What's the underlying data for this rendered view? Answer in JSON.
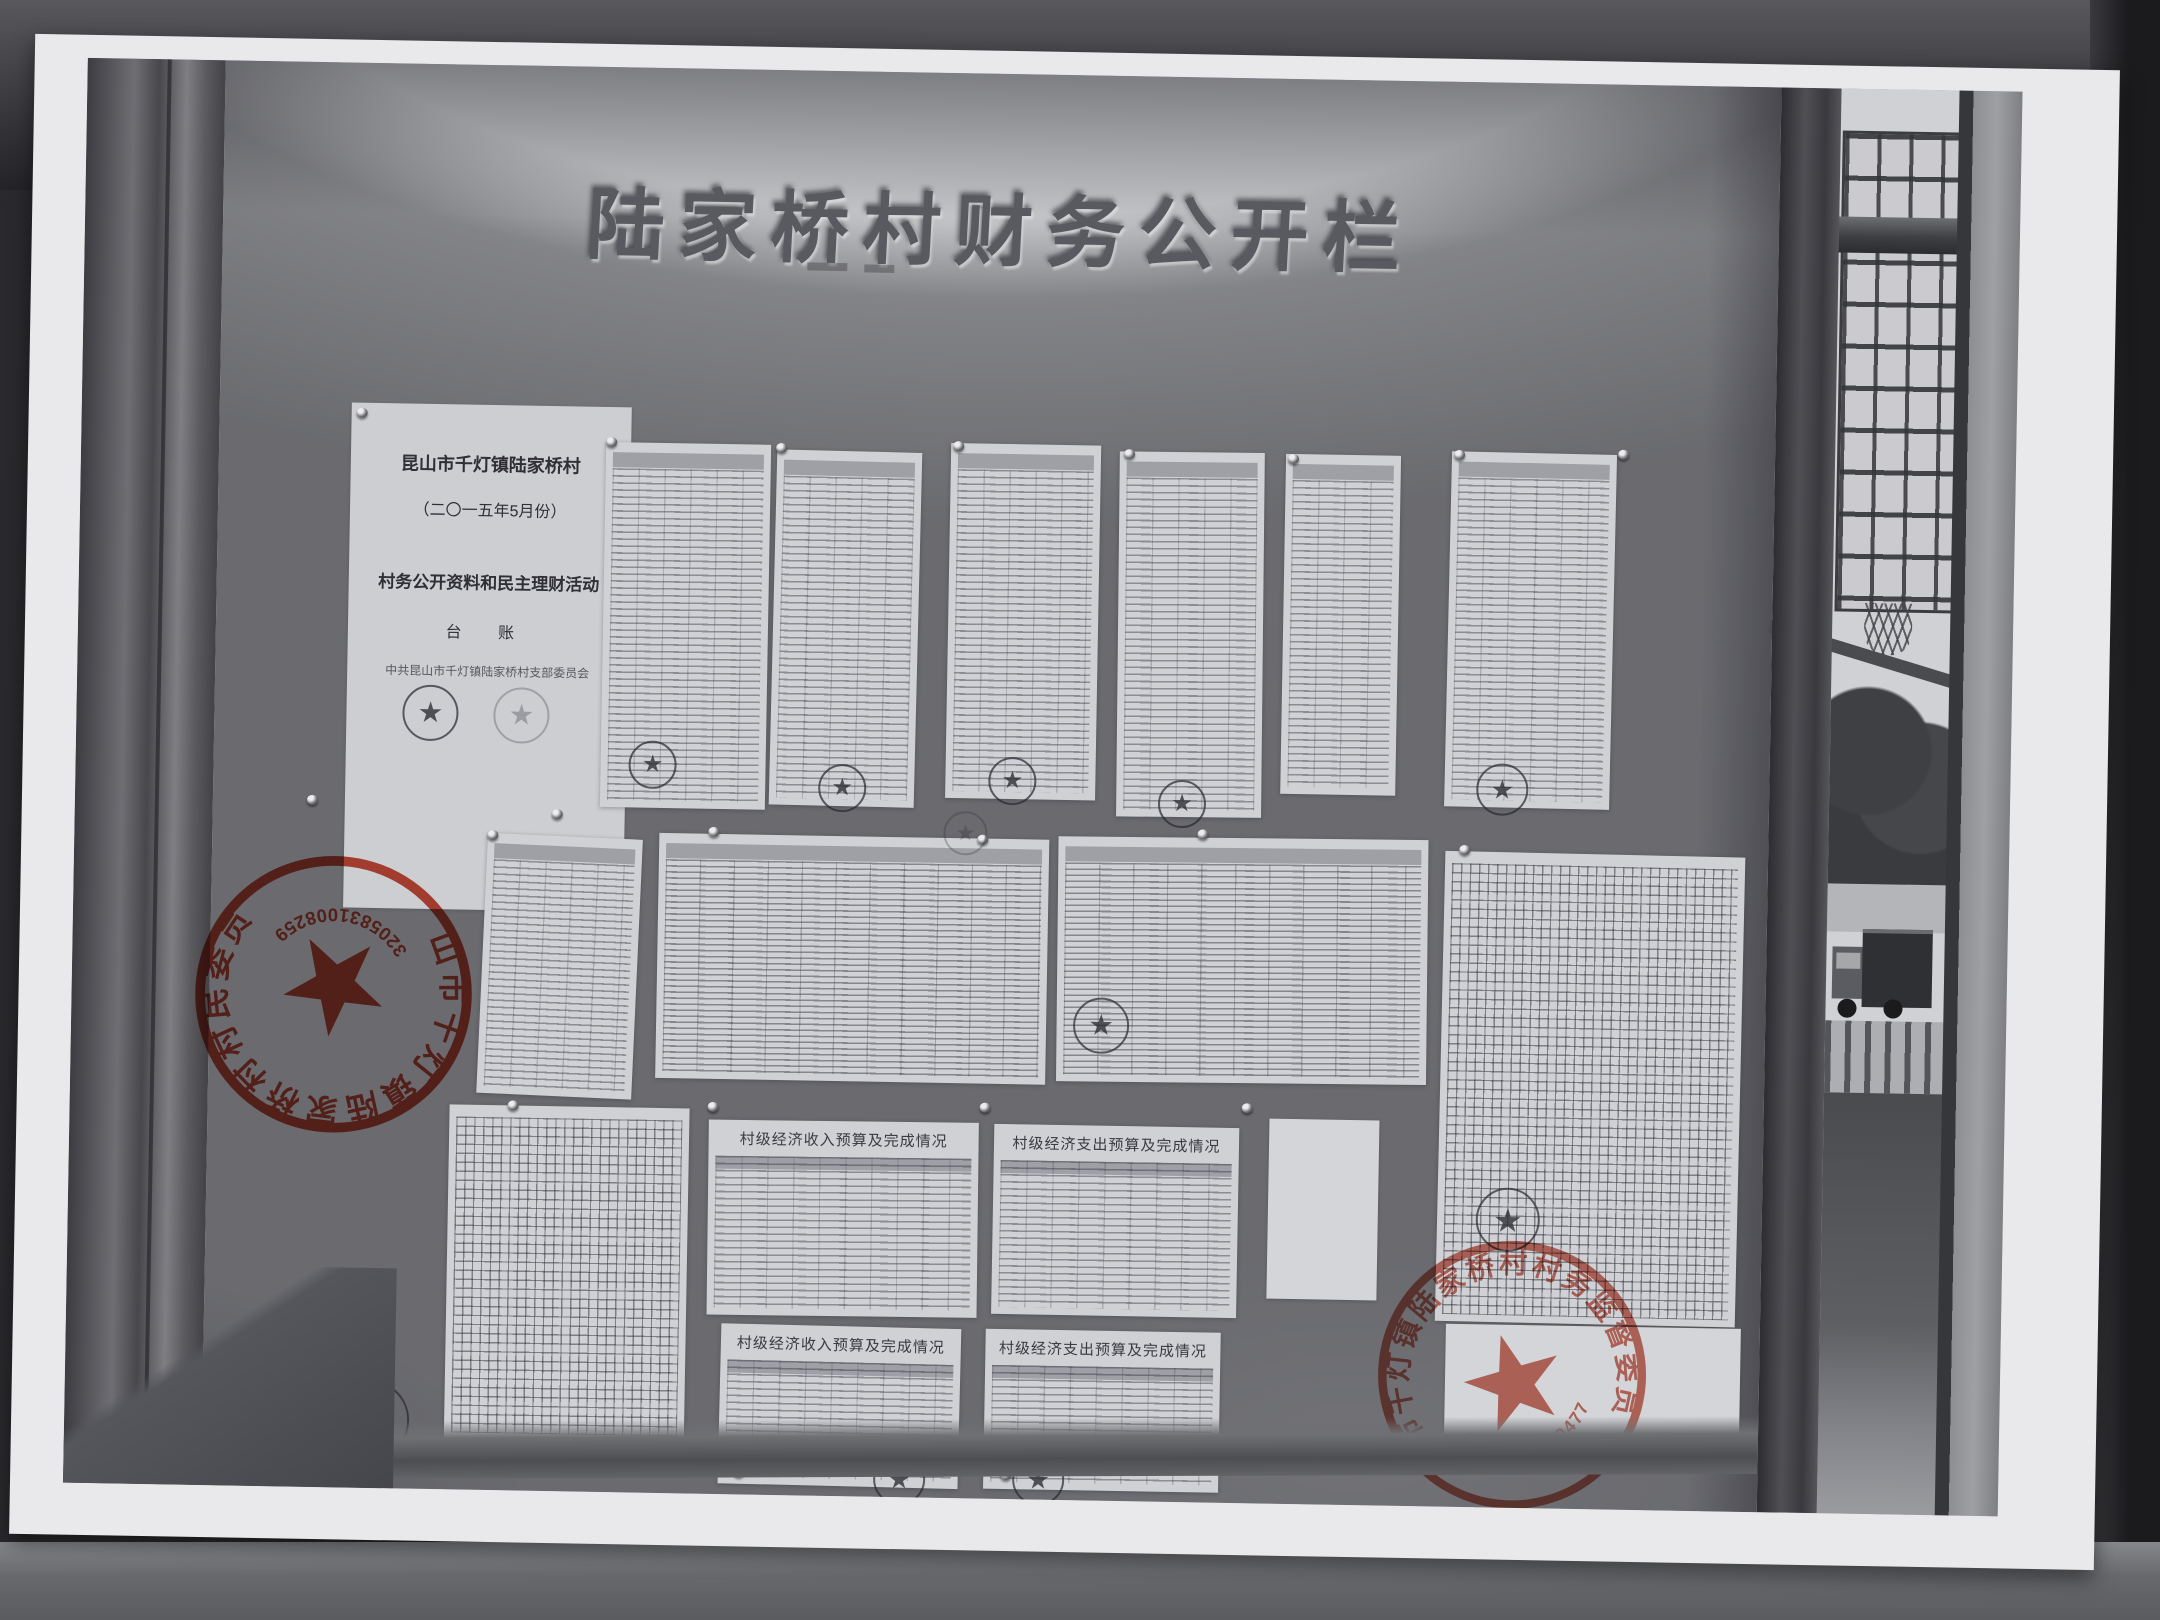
{
  "scene": {
    "type": "photograph of a printed photo: village financial disclosure notice board behind a window frame",
    "board_title": "陆家桥村财务公开栏"
  },
  "cover_page": {
    "line1": "昆山市千灯镇陆家桥村",
    "line2": "（二〇一五年5月份）",
    "line3": "村务公开资料和民主理财活动",
    "line4": "台  账",
    "line5": "中共昆山市千灯镇陆家桥村支部委员会"
  },
  "table_titles": {
    "income_budget_top": "村级经济收入预算及完成情况",
    "expense_budget_top": "村级经济支出预算及完成情况",
    "income_budget_bottom": "村级经济收入预算及完成情况",
    "expense_budget_bottom": "村级经济支出预算及完成情况"
  },
  "stamps": {
    "village_committee_seal": {
      "ring_text": "昆山市千灯镇陆家桥村村民委员会",
      "code": "3205831008259",
      "color": "#c5402e"
    },
    "supervision_committee_seal": {
      "ring_text": "昆山市千灯镇陆家桥村村务监督委员会",
      "code": "3205830470477",
      "color": "#c75f4e"
    }
  },
  "colors": {
    "stamp_red": "#c5402e",
    "board_gray": "#c6c7ca",
    "paper_white": "#e9e9ec",
    "background_dark": "#2a2a2e"
  }
}
